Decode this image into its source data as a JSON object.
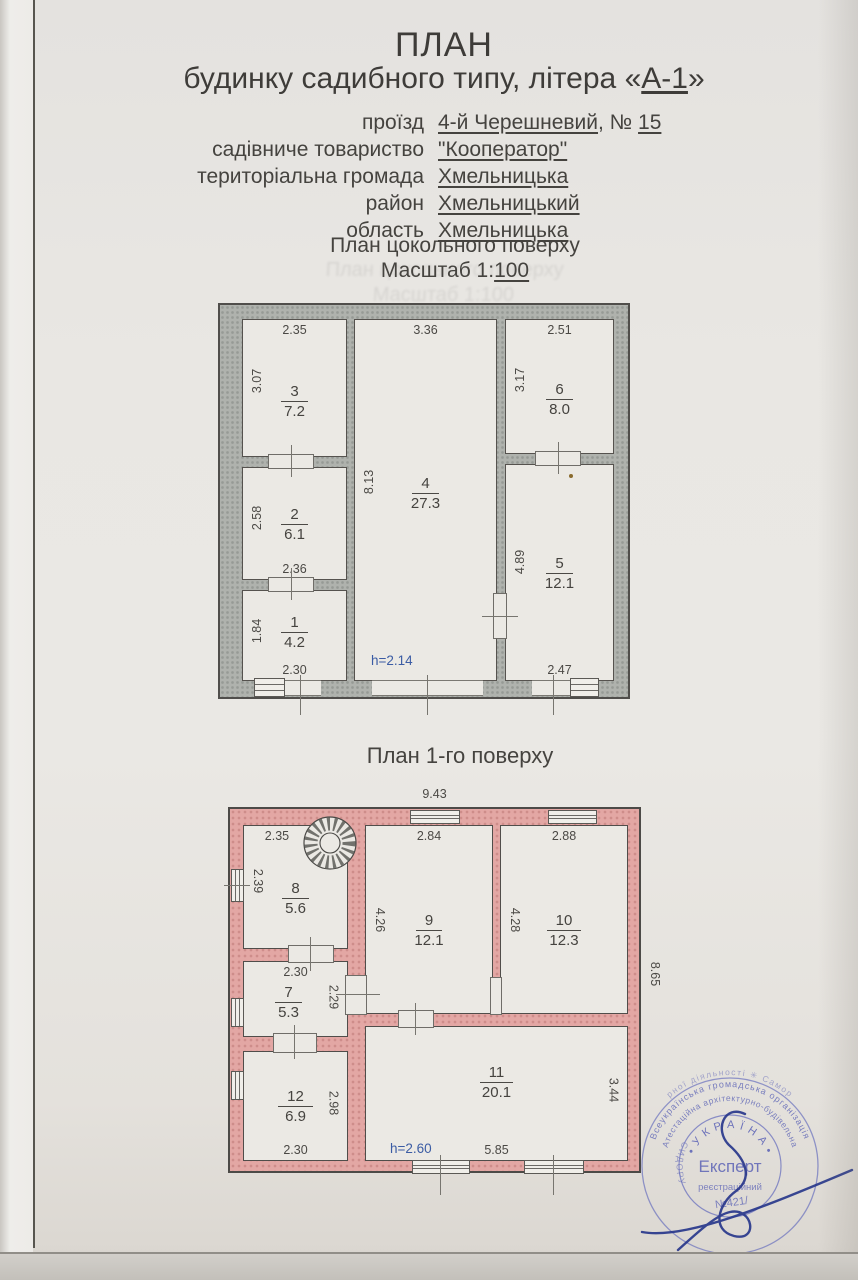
{
  "header": {
    "title": "ПЛАН",
    "subtitle_prefix": "будинку садибного типу, літера «",
    "subtitle_marked": "А-1",
    "subtitle_suffix": "»"
  },
  "address": {
    "rows": [
      {
        "label": "проїзд",
        "value": "4-й Черешневий",
        "sep": ", № ",
        "num": "15"
      },
      {
        "label": "садівниче товариство",
        "value": "\"Кооператор\""
      },
      {
        "label": "територіальна громада",
        "value": "Хмельницька"
      },
      {
        "label": "район",
        "value": "Хмельницький"
      },
      {
        "label": "область",
        "value": "Хмельницька"
      }
    ]
  },
  "basement": {
    "section_title": "План цокольного поверху",
    "scale_prefix": "Масштаб 1:",
    "scale_value": "100",
    "height_note": "h=2.14",
    "rooms": [
      {
        "num": "1",
        "area": "4.2",
        "left": "1.84",
        "bottom": "2.30"
      },
      {
        "num": "2",
        "area": "6.1",
        "left": "2.58",
        "bottom": "2.36"
      },
      {
        "num": "3",
        "area": "7.2",
        "top": "2.35",
        "left": "3.07"
      },
      {
        "num": "4",
        "area": "27.3",
        "top": "3.36",
        "left": "8.13"
      },
      {
        "num": "5",
        "area": "12.1",
        "left": "4.89",
        "bottom": "2.47"
      },
      {
        "num": "6",
        "area": "8.0",
        "top": "2.51",
        "left": "3.17"
      }
    ]
  },
  "floor1": {
    "section_title": "План 1-го поверху",
    "total_width": "9.43",
    "total_height": "8.65",
    "height_note": "h=2.60",
    "rooms": [
      {
        "num": "7",
        "area": "5.3",
        "top": "2.30",
        "right": "2.29"
      },
      {
        "num": "8",
        "area": "5.6",
        "top": "2.35",
        "left": "2.39"
      },
      {
        "num": "9",
        "area": "12.1",
        "top": "2.84",
        "left": "4.26"
      },
      {
        "num": "10",
        "area": "12.3",
        "top": "2.88",
        "left": "4.28"
      },
      {
        "num": "11",
        "area": "20.1",
        "right": "3.44",
        "bottom": "5.85"
      },
      {
        "num": "12",
        "area": "6.9",
        "right": "2.98",
        "bottom": "2.30"
      }
    ]
  },
  "stamp": {
    "ring_outer": "рної діяльності ✳ Самор",
    "ring_middle": "Всеукраїнська громадська організація",
    "ring_inner": "Атестаційна архітектурно-будівельна",
    "country": "• У К Р А Ї Н А •",
    "role": "Експерт",
    "registry_label": "реєстраційний",
    "registry_number": "№421/",
    "name_fragment": "СИДОРУ"
  },
  "colors": {
    "wall_gray": "#afb2ad",
    "wall_pink": "#e3a7a4",
    "wall_outline": "#4f4d4a",
    "paper": "#eae8e4",
    "dim_text": "#4b4945",
    "height_note_blue": "#3b5ca4",
    "stamp_blue": "#5d64b6",
    "signature_ink": "#25348a"
  }
}
